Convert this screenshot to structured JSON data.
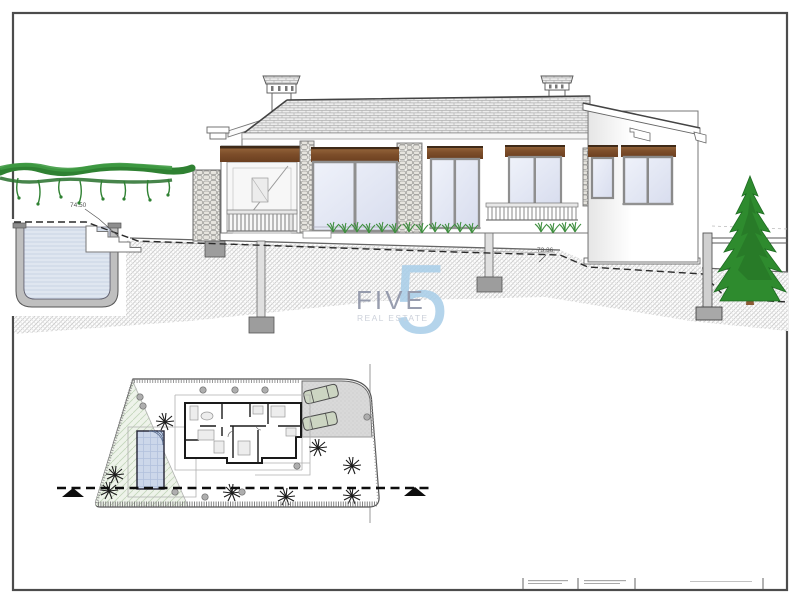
{
  "labels": {
    "level_left": "74.50",
    "level_mid": "73.36",
    "level_right": "73.29"
  },
  "watermark": {
    "word": "FIVE",
    "numeral": "5",
    "tagline": "REAL ESTATE",
    "word_color": "#8b91a5",
    "numeral_color": "#aacfe9",
    "tagline_color": "#c6cbd6"
  },
  "palette": {
    "frame": "#4c4c4c",
    "wood_lintel": "#7d4e2a",
    "glass": "#e3e8f5",
    "vine_green": "#2f8132",
    "tree_green": "#2e8b2e",
    "pool_water": "#ccd7ea",
    "terrain_hatch_line": "#c8c8c8",
    "section_line": "#0d0d0d",
    "parking_gray": "#d9d9d9"
  }
}
